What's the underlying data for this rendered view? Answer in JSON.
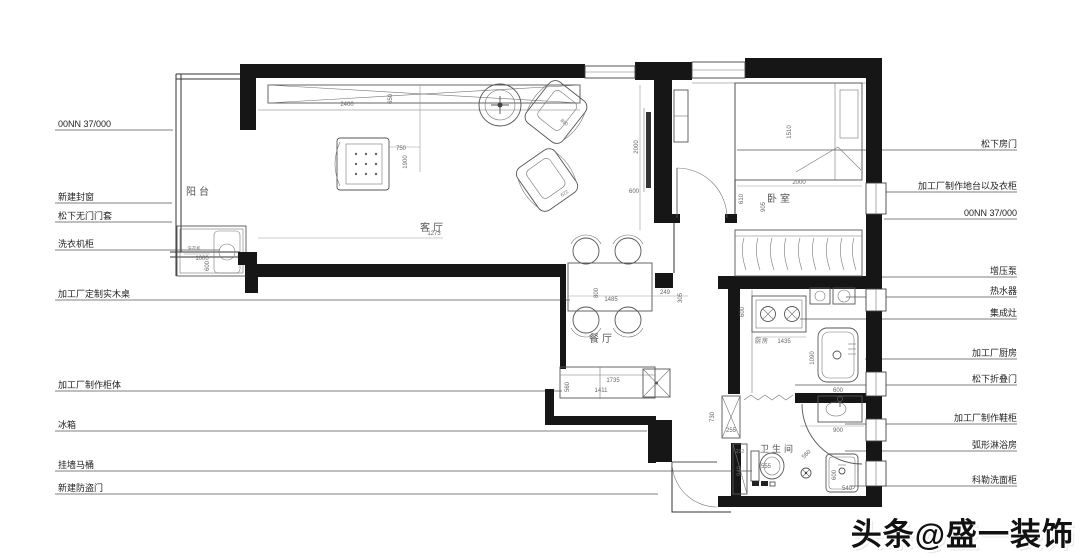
{
  "watermark": "头条@盛一装饰",
  "left_labels": [
    {
      "text": "00NN 37/000"
    },
    {
      "text": "新建封窗"
    },
    {
      "text": "松下无门门套"
    },
    {
      "text": "洗衣机柜"
    },
    {
      "text": "加工厂定制实木桌"
    },
    {
      "text": "加工厂制作柜体"
    },
    {
      "text": "冰箱"
    },
    {
      "text": "挂墙马桶"
    },
    {
      "text": "新建防盗门"
    }
  ],
  "right_labels": [
    {
      "text": "松下房门"
    },
    {
      "text": "加工厂制作地台以及衣柜"
    },
    {
      "text": "00NN 37/000"
    },
    {
      "text": "增压泵"
    },
    {
      "text": "热水器"
    },
    {
      "text": "集成灶"
    },
    {
      "text": "加工厂厨房"
    },
    {
      "text": "松下折叠门"
    },
    {
      "text": "加工厂制作鞋柜"
    },
    {
      "text": "弧形淋浴房"
    },
    {
      "text": "科勒洗面柜"
    }
  ],
  "rooms": {
    "balcony": "阳台",
    "living": "客厅",
    "dining": "餐厅",
    "bedroom": "卧室",
    "kitchen": "厨房",
    "bathroom": "卫生间"
  },
  "appliances": {
    "washer": "洗衣机"
  },
  "dims": {
    "top_cabinet_w": "2400",
    "top_cabinet_d": "650",
    "armchair_w": "750",
    "armchair_h": "1900",
    "washer_w": "1000",
    "washer_d": "600",
    "balcony_span": "1273",
    "tv_len": "2000",
    "tv_off": "600",
    "chair_a": "860",
    "chair_b": "672",
    "table_w": "800",
    "table_len": "1485",
    "gap_a": "249",
    "gap_b": "305",
    "bed_len": "1510",
    "bed_w": "2000",
    "bed_a": "610",
    "bed_b": "905",
    "cab_len": "1735",
    "cab_len2": "1411",
    "cab_d": "560",
    "kit_a": "600",
    "kit_len": "1435",
    "kit_b": "1090",
    "kit_c": "600",
    "hall_h": "730",
    "shoe_d": "255",
    "bath_a": "232",
    "bath_b": "940",
    "toilet_w": "555",
    "shower_w": "900",
    "shower_r": "560",
    "vanity_d": "600",
    "vanity_w": "540"
  }
}
